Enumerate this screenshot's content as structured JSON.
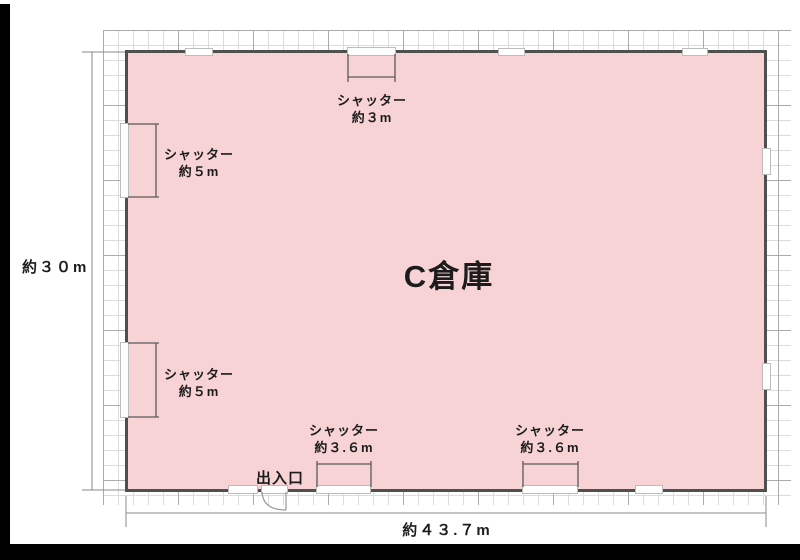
{
  "title": "C倉庫",
  "dimension_labels": {
    "height": "約３０m",
    "width": "約４３.７m"
  },
  "entrance_label": "出入口",
  "shutters": [
    {
      "name": "top",
      "line1": "シャッター",
      "line2": "約３m"
    },
    {
      "name": "left-upper",
      "line1": "シャッター",
      "line2": "約５m"
    },
    {
      "name": "left-lower",
      "line1": "シャッター",
      "line2": "約５m"
    },
    {
      "name": "bottom-left",
      "line1": "シャッター",
      "line2": "約３.６m"
    },
    {
      "name": "bottom-right",
      "line1": "シャッター",
      "line2": "約３.６m"
    }
  ],
  "colors": {
    "building_fill": "#f8d3d5",
    "wall": "#4f4f4f",
    "grid_minor": "#dcdcdc",
    "grid_major": "#ababab",
    "frame_bars": "#000000",
    "text": "#1c1c1c"
  }
}
